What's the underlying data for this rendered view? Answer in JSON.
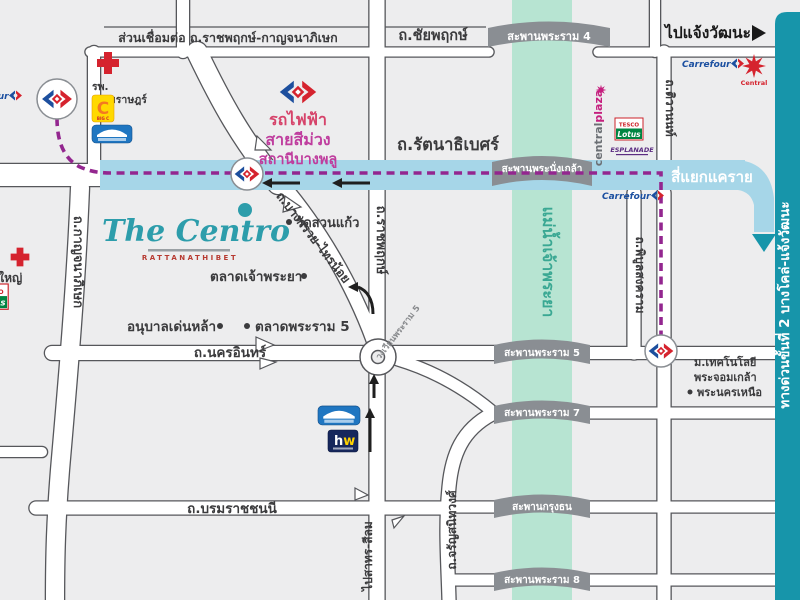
{
  "branding": {
    "logo_text": "The Centro",
    "logo_subtext": "RATTANATHIBET"
  },
  "metro": {
    "line1": "รถไฟฟ้า",
    "line2": "สายสีม่วง",
    "line3": "สถานีบางพลู"
  },
  "roads": {
    "connector": "ส่วนเชื่อมต่อ ถ.ราชพฤกษ์-กาญจนาภิเษก",
    "chaiyaphruek": "ถ.ชัยพฤกษ์",
    "rattanathibet": "ถ.รัตนาธิเบศร์",
    "kanchanaphisek": "ถ.กาญจนาภิเษก",
    "ratchaphruek": "ถ.ราชพฤกษ์",
    "bangkruai_sainoi": "ถ.บางกรวย-ไทรน้อย",
    "nakhon_in": "ถ.นครอินทร์",
    "borommaratchachonnani": "ถ.บรมราชชนนี",
    "charansanitwong": "ถ.จรัญสนิทวงศ์",
    "phibunsongkhram": "ถ.พิบูลสงคราม",
    "tiwanon": "ถ.ติวานนท์",
    "rama5_circle": "วงเวียนพระราม 5"
  },
  "directions": {
    "to_chaengwattana": "ไปแจ้งวัฒนะ",
    "to_sathorn_silom": "ไปสาทร-สีลม",
    "khae_rai": "สี่แยกแคราย",
    "expressway": "ทางด่วนขั้นที่ 2 บางโคล่-แจ้งวัฒนะ"
  },
  "river_label": "แม่น้ำเจ้าพระยา",
  "bridges": {
    "rama4": "สะพานพระราม 4",
    "phranangklao": "สะพานพระนั่งเกล้า",
    "rama5": "สะพานพระราม 5",
    "rama7": "สะพานพระราม 7",
    "krungthon": "สะพานกรุงธน",
    "rama8": "สะพานพระราม 8"
  },
  "places": {
    "hospital_line1": "รพ.",
    "hospital_line2": "เกษมราษฎร์",
    "bang_yai": "บางใหญ่",
    "wat_suan_kaew": "วัดสวนแก้ว",
    "talat_chaophraya": "ตลาดเจ้าพระยา",
    "anuban_denla": "อนุบาลเด่นหล้า",
    "talat_rama5": "ตลาดพระราม 5",
    "kmutnb_line1": "ม.เทคโนโลยี",
    "kmutnb_line2": "พระจอมเกล้า",
    "kmutnb_line3": "พระนครเหนือ"
  },
  "logos": {
    "carrefour": "Carrefour",
    "central": "Central",
    "bigc_letter": "C",
    "bigc_sub": "BIG C",
    "tesco": "TESCO",
    "lotus": "Lotus",
    "centralplaza_1": "central",
    "centralplaza_2": "plaza",
    "esplanade": "ESPLANADE",
    "hw_h": "h",
    "hw_w": "w"
  },
  "colors": {
    "river": "#b7e4d2",
    "road_band_blue": "#a6d6e8",
    "expressway_teal": "#1795aa",
    "purple_line": "#93268f",
    "bridge_gray": "#8a8e93",
    "text_dark": "#3b3b3d",
    "centro_teal": "#2d9dab",
    "centro_sub_red": "#b73a31"
  }
}
